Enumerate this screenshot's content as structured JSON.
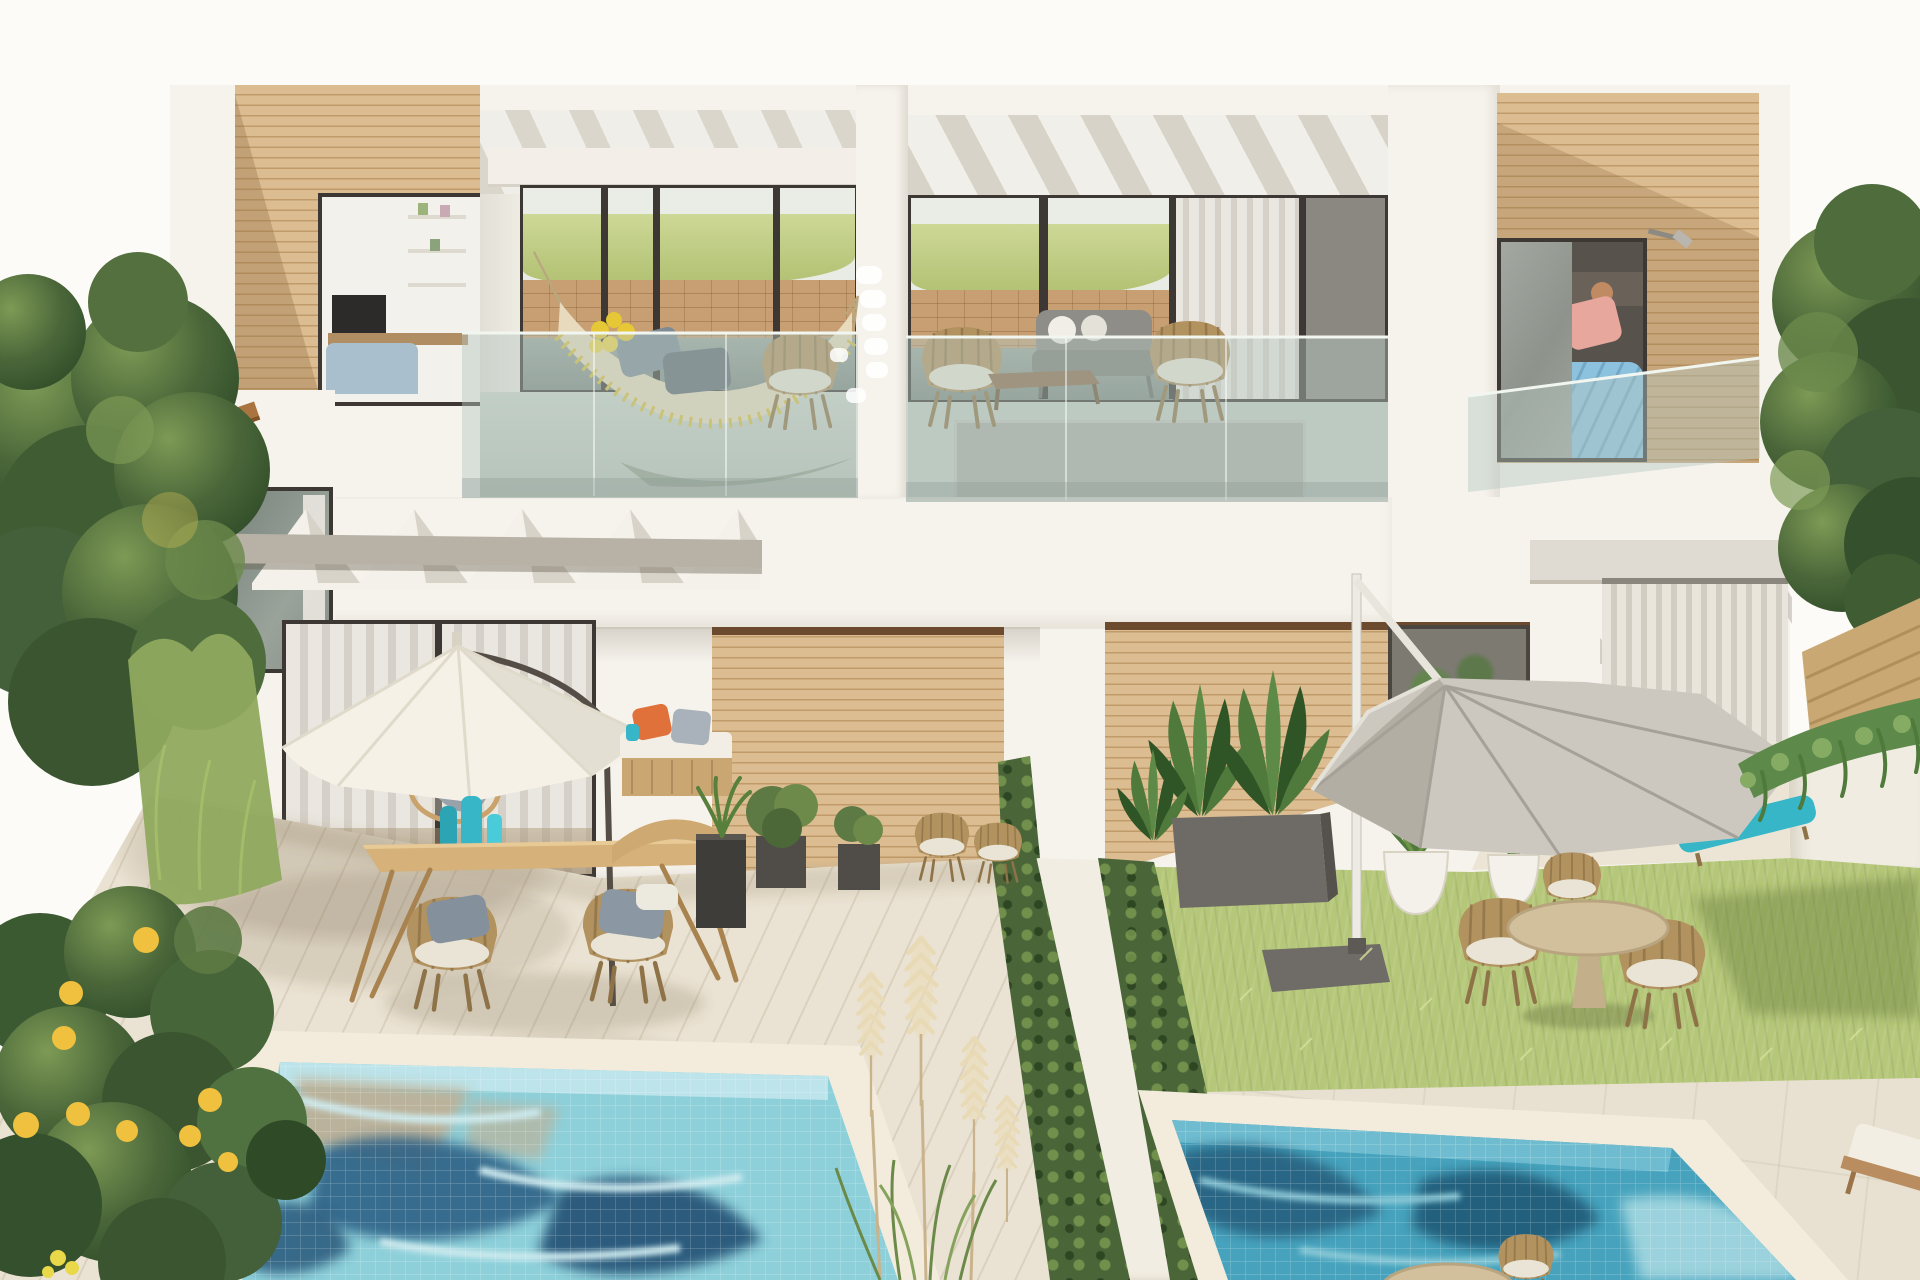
{
  "meta": {
    "type": "natural-image",
    "subject": "aerial render of a modern white duplex villa with wood-clad accents, two upper balconies, patio gardens and two tiled swimming pools"
  },
  "scene": {
    "upper_floor": [
      "wood-clad-block-left",
      "interior-window",
      "balcony-with-hammock",
      "pergola-beams",
      "balcony-with-wicker-lounge",
      "bedroom-with-open-door",
      "glass-balustrades",
      "wall-lamp"
    ],
    "ground_floor": [
      "curtained-sliding-doors",
      "hanging-egg-chair",
      "white-patio-umbrella",
      "daybed-with-orange-pillow",
      "wood-dining-table",
      "wicker-dining-chairs",
      "teal-vases",
      "wood-clad-walls",
      "planters-with-shrubs",
      "vertical-blind-door",
      "grey-cantilever-umbrella",
      "turquoise-sun-loungers",
      "round-garden-table-set",
      "white-round-pots"
    ],
    "landscape": [
      "timber-deck",
      "lawn",
      "stone-paving",
      "left-swimming-pool",
      "right-swimming-pool",
      "pampas-grass",
      "lemon-tree",
      "left-tree-cluster",
      "right-hedge",
      "timber-fence",
      "cascading-plants",
      "retaining-wall",
      "diagonal-garden-wall"
    ]
  },
  "palette": {
    "sky": "#fcfbf7",
    "wall": "#f6f3ed",
    "wall_shade": "#e8e4db",
    "wood": "#dcbd92",
    "wood_dark": "#c5a374",
    "wood_line": "#c09a68",
    "wood_shadow": "rgba(150,115,70,0.38)",
    "frame": "#3d3833",
    "glass_tint": "rgba(182,200,192,0.45)",
    "hill": "#b2c173",
    "hill_light": "#cdd896",
    "stone": "#c79f72",
    "curtain": "#eae7e0",
    "curtain_dark": "#d6d1c8",
    "concrete": "#b7b1a6",
    "hammock": "#e8dabc",
    "tassel": "#d9c041",
    "pillow_gray": "#7e8a94",
    "sofa_gray": "#8e8d87",
    "wicker": "#b2925f",
    "wicker_dark": "#8f7348",
    "table_wood": "#d6b179",
    "teal": "#37b6c8",
    "orange": "#e0713b",
    "bed_blue": "#8cc2de",
    "bed_pink": "#e8a79c",
    "skin": "#c08b62",
    "deck": "#eae2d2",
    "deck_line": "rgba(140,118,85,0.16)",
    "deck_shadow": "rgba(115,98,72,0.20)",
    "coping": "#f3ecdc",
    "pool_left": "#8ed0da",
    "pool_left_light": "#cdeaee",
    "pool_left_dark": "#2e6286",
    "pool_left_sand": "#c2ad90",
    "pool_right": "#47a3bd",
    "pool_right_dark": "#27617f",
    "pool_right_light": "#a5d8e0",
    "grass": "#b5c779",
    "grass_light": "#d0dc92",
    "grass_dark": "#93a95f",
    "grass_shadow": "rgba(85,105,45,0.35)",
    "tree": "#4a6639",
    "tree_dark": "#35502c",
    "tree_light": "#6c8a4b",
    "lemon": "#f0c13e",
    "pampas": "#e9dab6",
    "pampas_stem": "#c9b38c",
    "umbrella_white": "#f5f1e7",
    "umbrella_white_shade": "#e0dacb",
    "umbrella_gray": "#cdc8bf",
    "umbrella_gray_dark": "#a5a098",
    "paving": "#e8e1d1",
    "planter_dark": "#504d49",
    "pot_white": "#f4f1ea",
    "plant": "#4f7a3c",
    "plant_dark": "#2f5526"
  }
}
